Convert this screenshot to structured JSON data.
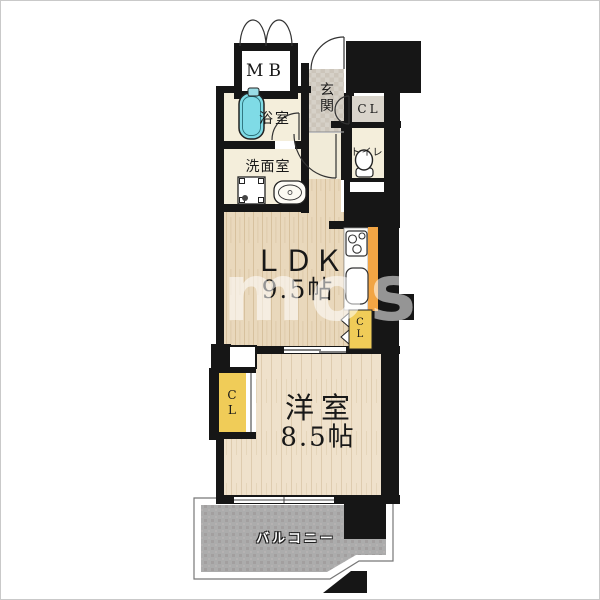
{
  "image": {
    "kind": "apartment-floorplan",
    "width": 600,
    "height": 600
  },
  "watermark": {
    "text": "mosu"
  },
  "colors": {
    "wall": "#161616",
    "tub": "#7fdbe6",
    "closet_yellow": "#f0cc58",
    "counter_orange": "#f2a544",
    "closet_gray": "#d9d4cb",
    "balcony_gray": "#acacac",
    "floor_wood": "#e9d8bc",
    "floor_wood_bedroom": "#efe1cb",
    "floor_cream": "#f4eedb",
    "genkan_tile": "#d6d1c8"
  },
  "rooms": {
    "mb": {
      "label": "MB"
    },
    "genkan": {
      "label": "玄関"
    },
    "closet_entrance": {
      "label": "CL"
    },
    "toilet": {
      "label": "トイレ"
    },
    "bath": {
      "label": "浴室"
    },
    "washroom": {
      "label": "洗面室"
    },
    "ldk": {
      "label": "ＬＤＫ",
      "size": "9.5帖"
    },
    "bedroom": {
      "label": "洋室",
      "size": "8.5帖"
    },
    "closet_ldk": {
      "label": "CL"
    },
    "closet_bedroom": {
      "label": "CL"
    },
    "balcony": {
      "label": "バルコニー"
    }
  },
  "icons": {
    "bathtub": "rounded-rect-with-inner-line",
    "washing_machine_pan": "square-with-corner-pads-and-drain",
    "vanity_sink": "rounded-rect-with-oval-basin",
    "toilet": "ellipse-bowl-with-base",
    "stove": "rect-with-three-burner-circles",
    "kitchen_sink": "rounded-rect-basin",
    "folding_door": "double-triangle-marks"
  }
}
